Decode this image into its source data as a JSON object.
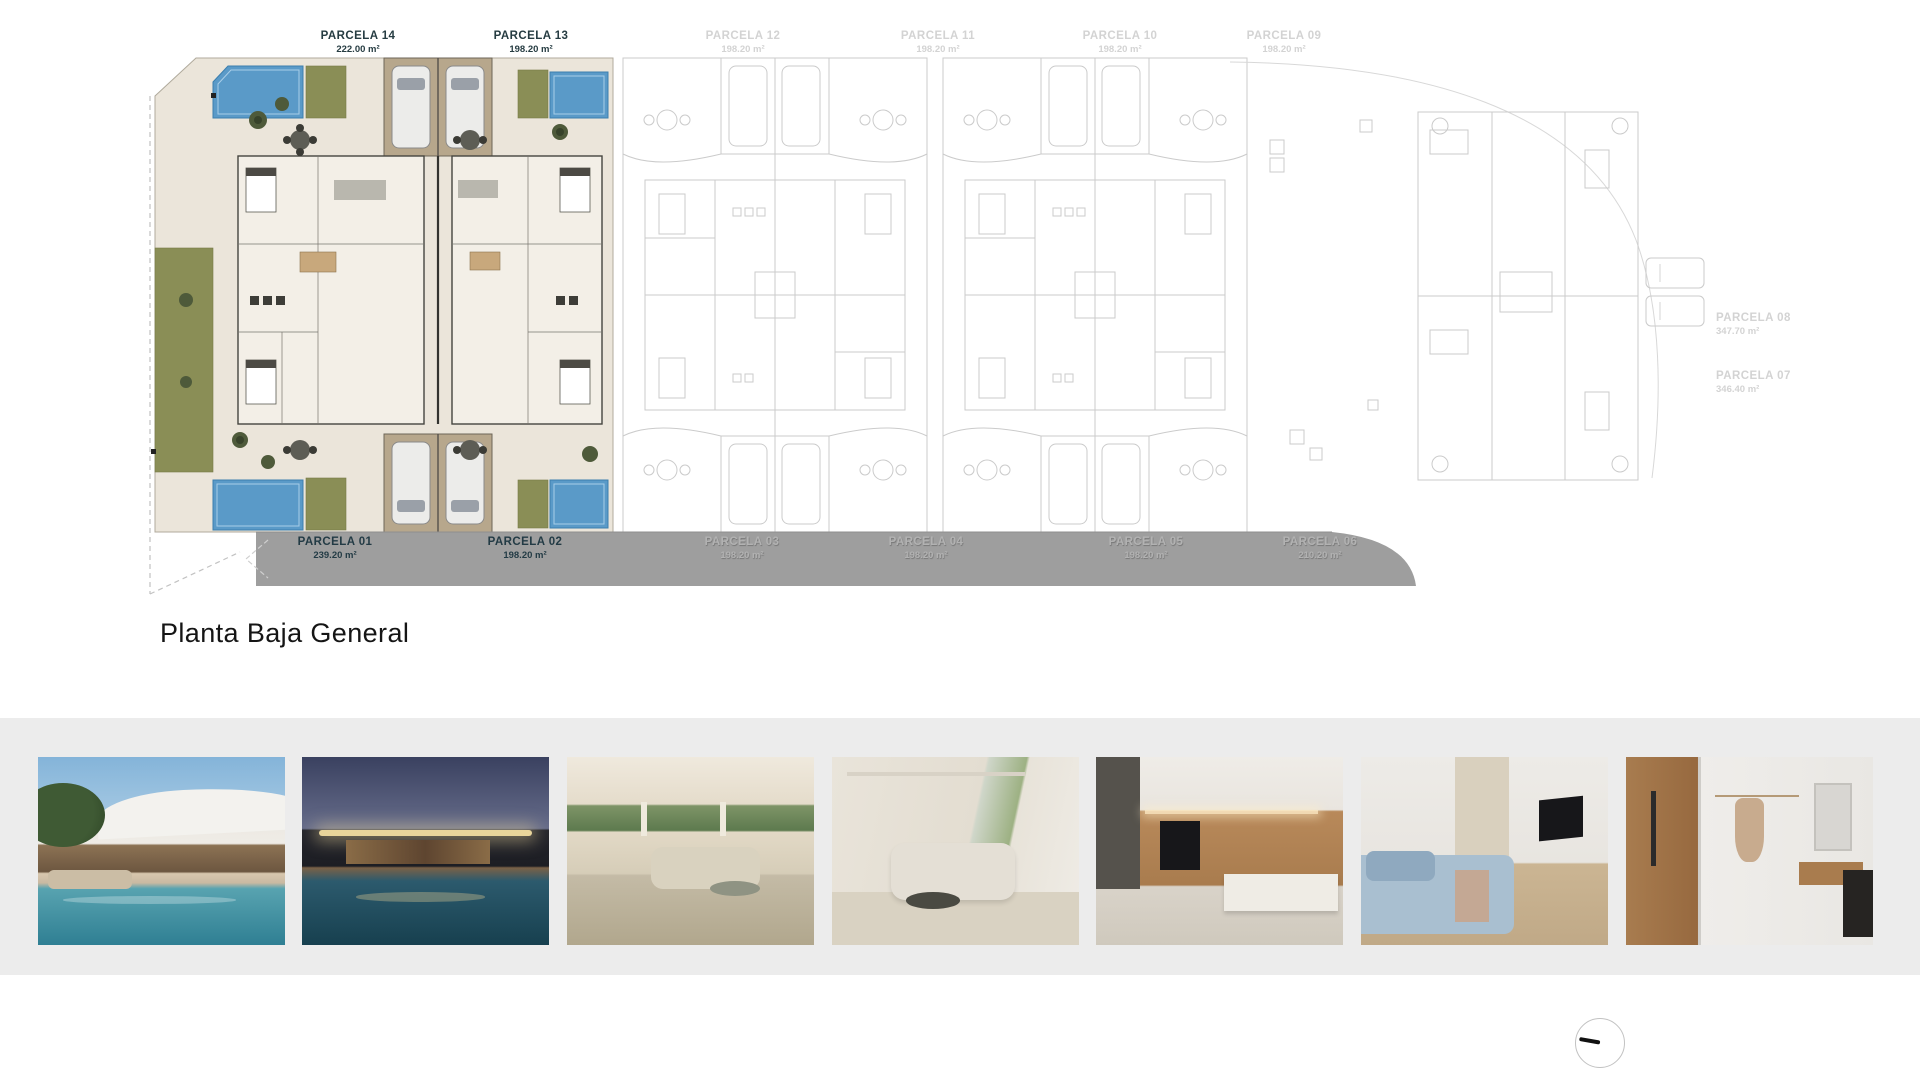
{
  "page": {
    "title": "Planta Baja General"
  },
  "plan": {
    "top_labels": [
      {
        "name": "PARCELA 14",
        "area": "222.00 m²",
        "state": "active"
      },
      {
        "name": "PARCELA 13",
        "area": "198.20 m²",
        "state": "active"
      },
      {
        "name": "PARCELA 12",
        "area": "198.20 m²",
        "state": "inactive"
      },
      {
        "name": "PARCELA 11",
        "area": "198.20 m²",
        "state": "inactive"
      },
      {
        "name": "PARCELA 10",
        "area": "198.20 m²",
        "state": "inactive"
      },
      {
        "name": "PARCELA 09",
        "area": "198.20 m²",
        "state": "inactive"
      }
    ],
    "right_labels": [
      {
        "name": "PARCELA 08",
        "area": "347.70 m²",
        "state": "inactive"
      },
      {
        "name": "PARCELA 07",
        "area": "346.40 m²",
        "state": "inactive"
      }
    ],
    "road_labels": [
      {
        "name": "PARCELA 01",
        "area": "239.20 m²",
        "state": "active"
      },
      {
        "name": "PARCELA 02",
        "area": "198.20 m²",
        "state": "active"
      },
      {
        "name": "PARCELA 03",
        "area": "198.20 m²",
        "state": "inactive"
      },
      {
        "name": "PARCELA 04",
        "area": "198.20 m²",
        "state": "inactive"
      },
      {
        "name": "PARCELA 05",
        "area": "198.20 m²",
        "state": "inactive"
      },
      {
        "name": "PARCELA 06",
        "area": "210.20 m²",
        "state": "inactive"
      }
    ]
  },
  "photos": [
    {
      "label": "villa-exterior-pool-day"
    },
    {
      "label": "villa-exterior-night"
    },
    {
      "label": "living-room-terrace-view"
    },
    {
      "label": "living-room-interior"
    },
    {
      "label": "kitchen-dining-interior"
    },
    {
      "label": "bedroom-interior"
    },
    {
      "label": "bathroom-interior"
    }
  ],
  "colors": {
    "active_label": "#263c42",
    "inactive_label": "#d3d3d3",
    "road": "#9e9e9e",
    "pool": "#5a9ac8",
    "grass": "#8a8e56",
    "plan_background": "#ebe5da",
    "strip_background": "#ececec"
  }
}
